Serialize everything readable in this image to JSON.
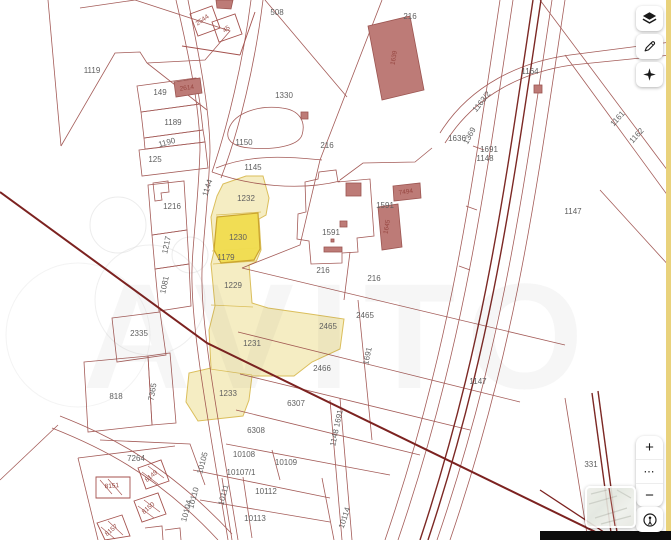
{
  "map": {
    "watermark": "AVITO",
    "background_color": "#ffffff",
    "boundary_line_color": "#9a4a46",
    "thick_line_color": "#7c2220",
    "building_fill_color": "#bd7b77",
    "highlight_fill_color": "#f5ecbe",
    "selected_fill_color": "#f1dd4f",
    "edge_strip_color": "#e9d27c",
    "highlighted_parcels": [
      "1232",
      "1230",
      "1179",
      "1229",
      "1231",
      "1233"
    ],
    "selected_parcel": "1230",
    "labels": [
      {
        "t": "1119",
        "x": 92,
        "y": 71
      },
      {
        "t": "149",
        "x": 160,
        "y": 93
      },
      {
        "t": "1189",
        "x": 173,
        "y": 123
      },
      {
        "t": "1190",
        "x": 167,
        "y": 143,
        "r": -15
      },
      {
        "t": "125",
        "x": 155,
        "y": 160
      },
      {
        "t": "2614",
        "x": 187,
        "y": 89,
        "r": -8,
        "c": "r"
      },
      {
        "t": "2544",
        "x": 203,
        "y": 21,
        "r": -35,
        "c": "r"
      },
      {
        "t": "45",
        "x": 227,
        "y": 30,
        "r": -35,
        "c": "r"
      },
      {
        "t": "508",
        "x": 277,
        "y": 13
      },
      {
        "t": "1330",
        "x": 284,
        "y": 96
      },
      {
        "t": "216",
        "x": 327,
        "y": 146
      },
      {
        "t": "216",
        "x": 410,
        "y": 17
      },
      {
        "t": "1639",
        "x": 395,
        "y": 58,
        "r": -80,
        "c": "r"
      },
      {
        "t": "1150",
        "x": 244,
        "y": 143
      },
      {
        "t": "1145",
        "x": 253,
        "y": 168
      },
      {
        "t": "1144",
        "x": 208,
        "y": 188,
        "r": -72
      },
      {
        "t": "1216",
        "x": 172,
        "y": 207
      },
      {
        "t": "1217",
        "x": 167,
        "y": 245,
        "r": -78
      },
      {
        "t": "1081",
        "x": 165,
        "y": 285,
        "r": -78
      },
      {
        "t": "2335",
        "x": 139,
        "y": 334
      },
      {
        "t": "818",
        "x": 116,
        "y": 397
      },
      {
        "t": "7365",
        "x": 153,
        "y": 392,
        "r": -80
      },
      {
        "t": "7264",
        "x": 136,
        "y": 459
      },
      {
        "t": "1232",
        "x": 246,
        "y": 199
      },
      {
        "t": "1230",
        "x": 238,
        "y": 238
      },
      {
        "t": "1179",
        "x": 226,
        "y": 258
      },
      {
        "t": "1229",
        "x": 233,
        "y": 286
      },
      {
        "t": "1231",
        "x": 252,
        "y": 344
      },
      {
        "t": "1233",
        "x": 228,
        "y": 394
      },
      {
        "t": "1591",
        "x": 331,
        "y": 233
      },
      {
        "t": "1591",
        "x": 385,
        "y": 206
      },
      {
        "t": "7494",
        "x": 406,
        "y": 193,
        "r": -8,
        "c": "r"
      },
      {
        "t": "1645",
        "x": 388,
        "y": 227,
        "r": -80,
        "c": "r"
      },
      {
        "t": "216",
        "x": 323,
        "y": 271
      },
      {
        "t": "216",
        "x": 374,
        "y": 279
      },
      {
        "t": "2465",
        "x": 365,
        "y": 316
      },
      {
        "t": "2465",
        "x": 328,
        "y": 327
      },
      {
        "t": "2466",
        "x": 322,
        "y": 369
      },
      {
        "t": "6307",
        "x": 296,
        "y": 404
      },
      {
        "t": "6308",
        "x": 256,
        "y": 431
      },
      {
        "t": "10108",
        "x": 244,
        "y": 455
      },
      {
        "t": "10109",
        "x": 286,
        "y": 463
      },
      {
        "t": "10105",
        "x": 203,
        "y": 463,
        "r": -75
      },
      {
        "t": "10107/1",
        "x": 241,
        "y": 473
      },
      {
        "t": "10110",
        "x": 194,
        "y": 498,
        "r": -75
      },
      {
        "t": "10111",
        "x": 224,
        "y": 495,
        "r": -75
      },
      {
        "t": "10112",
        "x": 266,
        "y": 492
      },
      {
        "t": "10113",
        "x": 255,
        "y": 519
      },
      {
        "t": "10104",
        "x": 187,
        "y": 511,
        "r": -75
      },
      {
        "t": "10114",
        "x": 345,
        "y": 518,
        "r": -72
      },
      {
        "t": "1148 1691",
        "x": 337,
        "y": 428,
        "r": -78
      },
      {
        "t": "1691",
        "x": 368,
        "y": 356,
        "r": -78
      },
      {
        "t": "1164",
        "x": 530,
        "y": 72
      },
      {
        "t": "1163/2",
        "x": 482,
        "y": 102,
        "r": -52
      },
      {
        "t": "1636",
        "x": 457,
        "y": 139
      },
      {
        "t": "1369",
        "x": 470,
        "y": 136,
        "r": -62
      },
      {
        "t": "1691",
        "x": 489,
        "y": 150
      },
      {
        "t": "1148",
        "x": 485,
        "y": 159
      },
      {
        "t": "1147",
        "x": 573,
        "y": 212
      },
      {
        "t": "1147",
        "x": 478,
        "y": 382
      },
      {
        "t": "1161",
        "x": 618,
        "y": 119,
        "r": -48
      },
      {
        "t": "1162",
        "x": 637,
        "y": 136,
        "r": -48
      },
      {
        "t": "331",
        "x": 591,
        "y": 465
      },
      {
        "t": "8149",
        "x": 152,
        "y": 477,
        "r": -40,
        "c": "r"
      },
      {
        "t": "8151",
        "x": 112,
        "y": 487,
        "r": -5,
        "c": "r"
      },
      {
        "t": "8150",
        "x": 149,
        "y": 509,
        "r": -40,
        "c": "r"
      },
      {
        "t": "8157",
        "x": 112,
        "y": 531,
        "r": -40,
        "c": "r"
      }
    ]
  },
  "controls": {
    "zoom_in": "+",
    "zoom_more": "⋯",
    "zoom_out": "−"
  }
}
